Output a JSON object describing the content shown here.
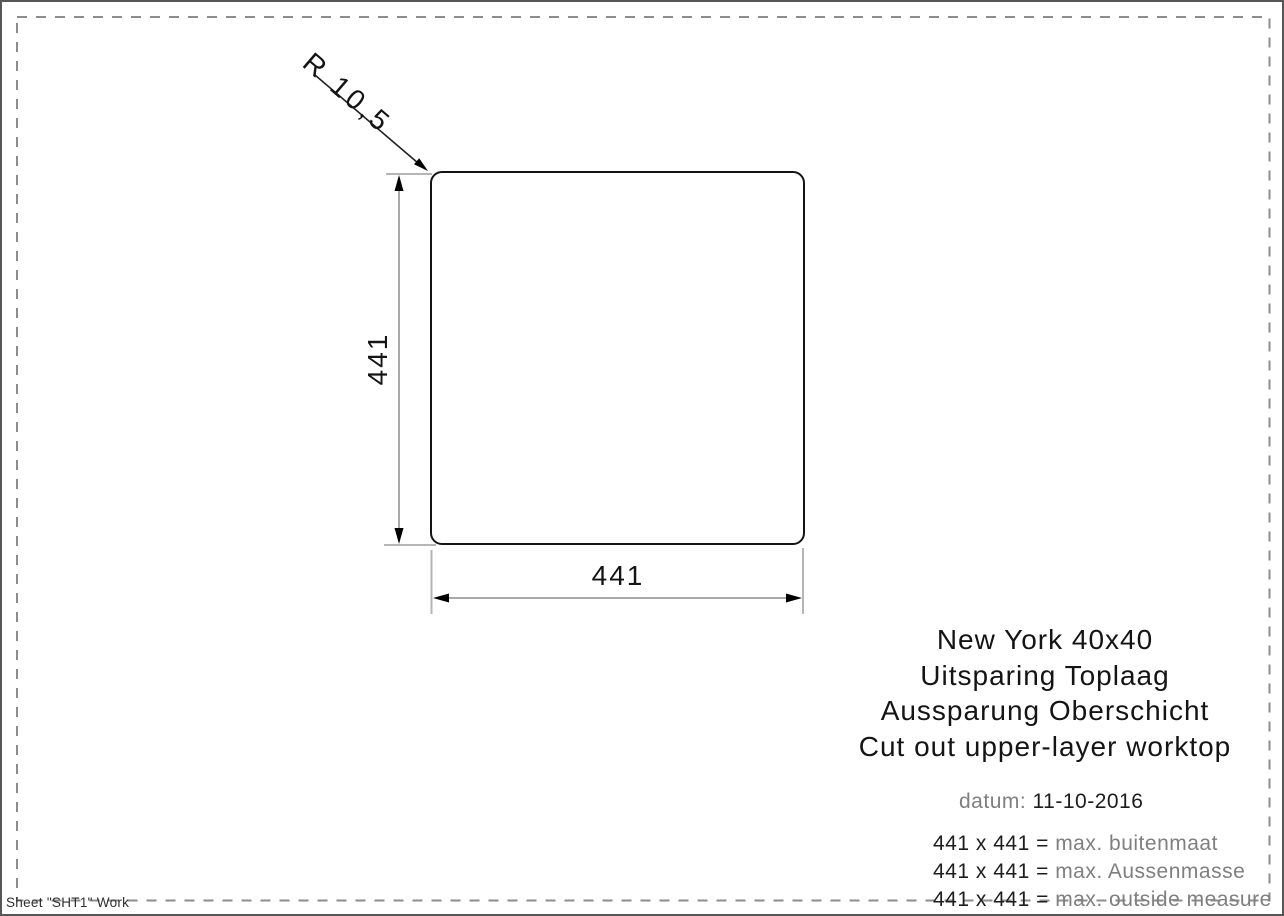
{
  "drawing": {
    "radius_label": "R 10,5",
    "height_dim": "441",
    "width_dim": "441"
  },
  "title_block": {
    "lines": [
      "New York 40x40",
      "Uitsparing Toplaag",
      "Aussparung Oberschicht",
      "Cut out upper-layer worktop"
    ]
  },
  "info": {
    "datum_label": "datum:",
    "datum_value": "11-10-2016",
    "measures": [
      {
        "dims": "441 x 441 =",
        "label": "max. buitenmaat"
      },
      {
        "dims": "441 x 441 =",
        "label": "max. Aussenmasse"
      },
      {
        "dims": "441 x 441 =",
        "label": "max. outside measure"
      }
    ]
  },
  "footer": {
    "sheet_label": "Sheet \"SHT1\" Work"
  },
  "colors": {
    "outline": "#141414",
    "dimension_line": "#a9a9a9",
    "extension_line": "#b5b5b5",
    "dashed_border": "#8d8d8d",
    "text_primary": "#1d1d1d",
    "text_secondary": "#7f7f7f"
  }
}
